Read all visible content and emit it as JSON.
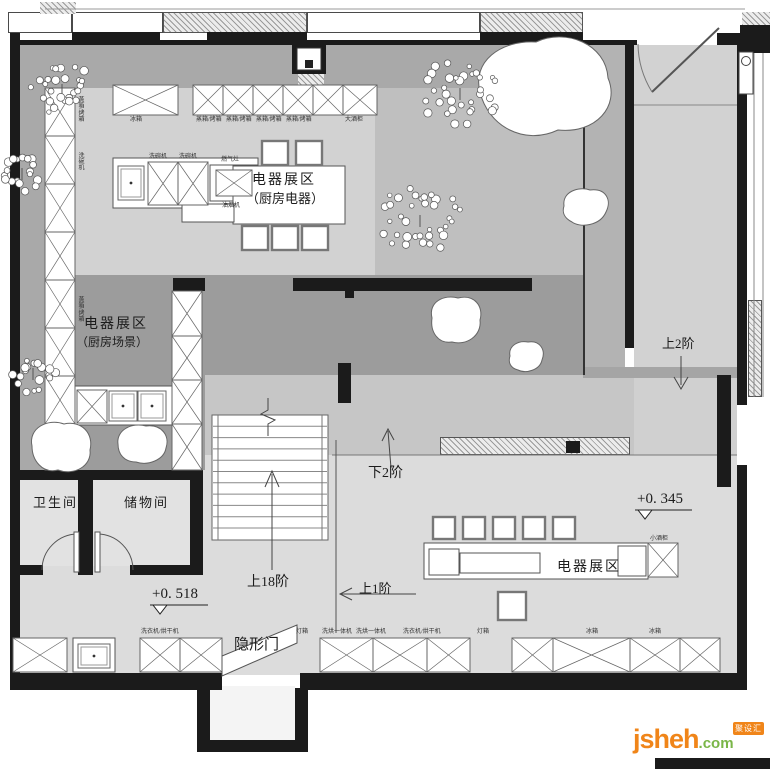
{
  "colors": {
    "wall": "#1b1b1b",
    "corridor": "#a9a9a9",
    "kitchen_floor": "#d2d2d2",
    "trees_zone": "#bfbfbf",
    "dark_band": "#9c9c9c",
    "mid_band": "#c6c6c6",
    "lower_floor": "#dcdcdc",
    "entry": "#d2d2d2",
    "room": "#e2e2e2",
    "logo_orange": "#f08519",
    "logo_green": "#7ab648"
  },
  "areas": {
    "kitchen_appliance_1": "电器展区",
    "kitchen_appliance_2": "（厨房电器）",
    "kitchen_scene_1": "电器展区",
    "kitchen_scene_2": "（厨房场景）",
    "display": "电器展区",
    "bathroom": "卫生间",
    "storage": "储物间",
    "hidden_door": "隐形门"
  },
  "markers": {
    "up2": "上2阶",
    "down2": "下2阶",
    "up18": "上18阶",
    "up1": "上1阶",
    "level_518": "+0. 518",
    "level_345": "+0. 345"
  },
  "fixtures": {
    "top_row": [
      "冰箱",
      "蒸箱/烤箱",
      "蒸箱/烤箱",
      "蒸箱/烤箱",
      "蒸箱/烤箱",
      "大酒柜"
    ],
    "island_top": [
      "洗碗机",
      "洗碗机",
      "燃气灶"
    ],
    "island_bottom": "油烟机",
    "left_col": [
      "蒸箱/烤箱",
      "洗碗机",
      "蒸箱/烤箱"
    ],
    "wine_small": "小酒柜",
    "bottom_row": [
      "洗衣机/烘干机",
      "灯箱",
      "洗烘一体机",
      "洗烘一体机",
      "洗衣机/烘干机",
      "灯箱",
      "冰箱",
      "冰箱"
    ]
  },
  "logo": {
    "name": "jsheh",
    "tld": ".com",
    "badge": "聚设汇"
  }
}
